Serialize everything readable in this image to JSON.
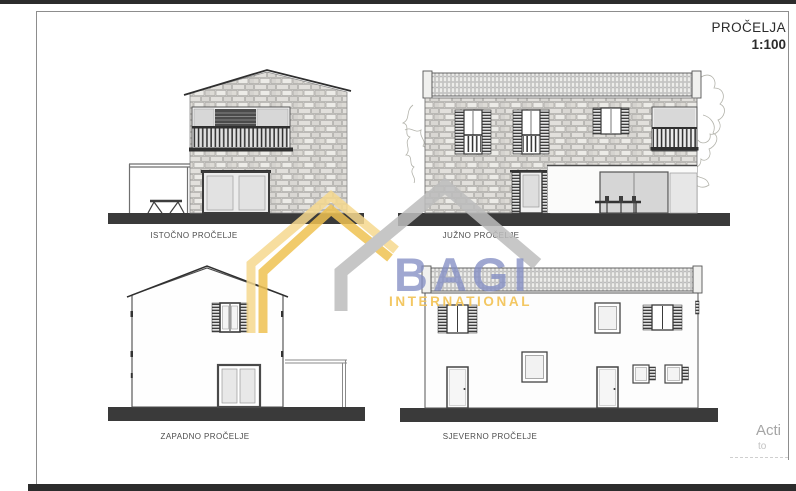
{
  "page": {
    "title": "PROČELJA",
    "scale": "1:100"
  },
  "facades": [
    {
      "id": "east",
      "label": "ISTOČNO PROČELJE"
    },
    {
      "id": "south",
      "label": "JUŽNO PROČELJE"
    },
    {
      "id": "west",
      "label": "ZAPADNO PROČELJE"
    },
    {
      "id": "north",
      "label": "SJEVERNO PROČELJE"
    }
  ],
  "watermark": {
    "brand": "BAGI",
    "subtitle": "INTERNATIONAL"
  },
  "system_overlay": {
    "line1": "Acti",
    "line2": "to"
  },
  "colors": {
    "logo_blue": "#848EC4",
    "logo_gold": "#EFC252",
    "logo_gold_pale": "#F6D98F",
    "logo_gray": "#BDBDBD",
    "ground": "#3A3A3A"
  }
}
